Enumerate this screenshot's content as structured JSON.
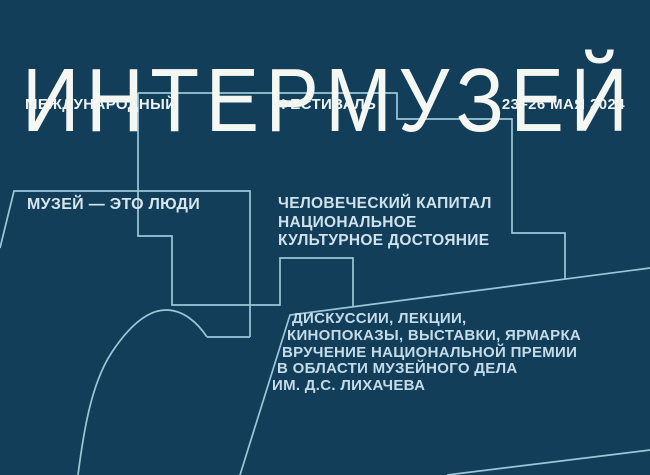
{
  "theme": {
    "background_color": "#123e5a",
    "line_color": "#9cc6d8",
    "headline_color": "#f5f7f3",
    "header_text_color": "#eef3f2",
    "body_text_color": "#cfe1ea"
  },
  "header": {
    "title": "ИНТЕРМУЗЕЙ",
    "subtitle_left": "МЕЖДУНАРОДНЫЙ",
    "subtitle_center": "ФЕСТИВАЛЬ",
    "dates": "23–26 МАЯ 2024"
  },
  "slogan": {
    "label": "МУЗЕЙ — ЭТО ЛЮДИ"
  },
  "theme_block": {
    "lines": [
      "ЧЕЛОВЕЧЕСКИЙ КАПИТАЛ",
      "НАЦИОНАЛЬНОЕ",
      "КУЛЬТУРНОЕ ДОСТОЯНИЕ"
    ]
  },
  "events_block": {
    "lines": [
      "ДИСКУССИИ, ЛЕКЦИИ,",
      "КИНОПОКАЗЫ, ВЫСТАВКИ, ЯРМАРКА",
      "ВРУЧЕНИЕ НАЦИОНАЛЬНОЙ ПРЕМИИ",
      "В ОБЛАСТИ МУЗЕЙНОГО ДЕЛА",
      "ИМ. Д.С. ЛИХАЧЕВА"
    ]
  }
}
